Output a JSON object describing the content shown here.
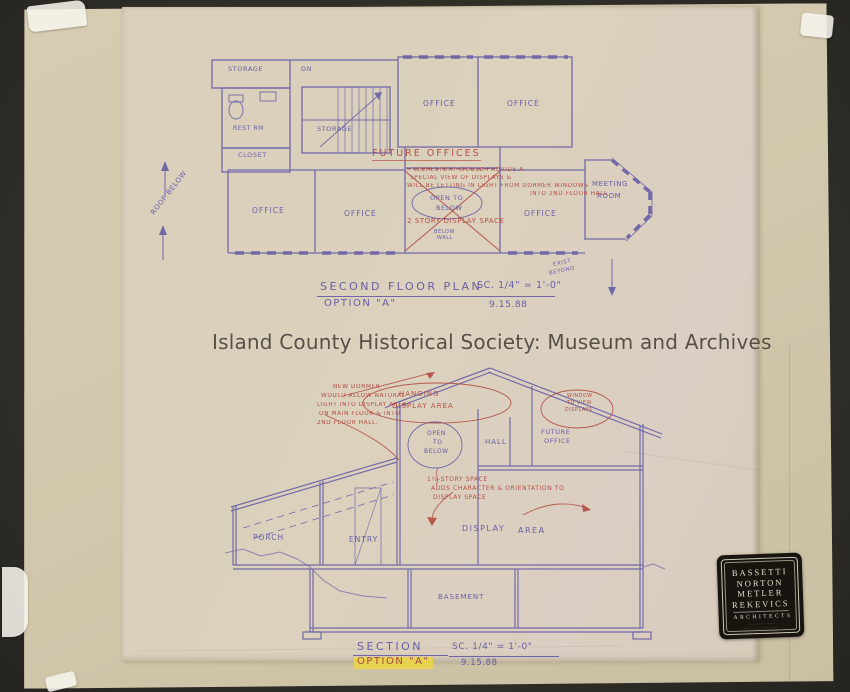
{
  "watermark": {
    "text": "Island County Historical Society: Museum and Archives"
  },
  "colors": {
    "background": "#2e2c26",
    "backing_paper": "#d2c8ad",
    "tracing_paper": "#d9d0bc",
    "ink_blue": "#5b53a4",
    "ink_red": "#b0443c",
    "highlight_yellow": "#f0d73c",
    "stamp_black": "#181510"
  },
  "floor_plan": {
    "title": "SECOND FLOOR PLAN",
    "scale": "SC. 1/4\" = 1'-0\"",
    "option": "OPTION \"A\"",
    "date": "9.15.88",
    "labels": {
      "storage": "STORAGE",
      "dn": "DN",
      "stair_storage": "STORAGE",
      "rest_rm": "REST RM",
      "closet": "CLOSET",
      "office": "OFFICE",
      "future_offices": "FUTURE OFFICES",
      "meeting_1": "MEETING",
      "meeting_2": "ROOM",
      "open_to": "OPEN TO",
      "open_below": "BELOW",
      "two_story": "2 STORY DISPLAY SPACE",
      "below_1": "BELOW",
      "below_2": "WALL",
      "roof_below": "ROOF BELOW",
      "exist_1": "EXIST",
      "exist_2": "BEYOND"
    },
    "note_clerestory": [
      "CLERESTORY WOULD PROVIDE A",
      "SPECIAL VIEW OF DISPLAYS &",
      "WILL BE LETTING IN LIGHT FROM DORMER WINDOWS",
      "INTO 2ND FLOOR HALL"
    ]
  },
  "section": {
    "title": "SECTION",
    "scale": "SC. 1/4\" = 1'-0\"",
    "option": "OPTION \"A\"",
    "date": "9.15.88",
    "labels": {
      "hanging_1": "HANGING",
      "hanging_2": "DISPLAY AREA",
      "window_1": "WINDOW",
      "window_2": "TO VIEW",
      "window_3": "DISPLAYS",
      "open_1": "OPEN",
      "open_2": "TO",
      "open_3": "BELOW",
      "hall": "HALL",
      "future_1": "FUTURE",
      "future_2": "OFFICE",
      "porch": "PORCH",
      "entry": "ENTRY",
      "display": "DISPLAY",
      "area": "AREA",
      "basement": "BASEMENT"
    },
    "note_dormer": [
      "NEW DORMER",
      "WOULD ALLOW NATURAL",
      "LIGHT INTO DISPLAY AREA",
      "ON MAIN FLOOR & INTO",
      "2ND FLOOR HALL."
    ],
    "note_space": [
      "1½-STORY SPACE",
      "ADDS CHARACTER & ORIENTATION TO",
      "DISPLAY SPACE"
    ]
  },
  "stamp": {
    "names": [
      "BASSETTI",
      "NORTON",
      "METLER",
      "REKEVICS"
    ],
    "profession": "ARCHITECTS",
    "fine_print": [
      "···· ······· ······",
      "······· ·········· ·····",
      "····· ··· ···· ··· ····"
    ]
  }
}
